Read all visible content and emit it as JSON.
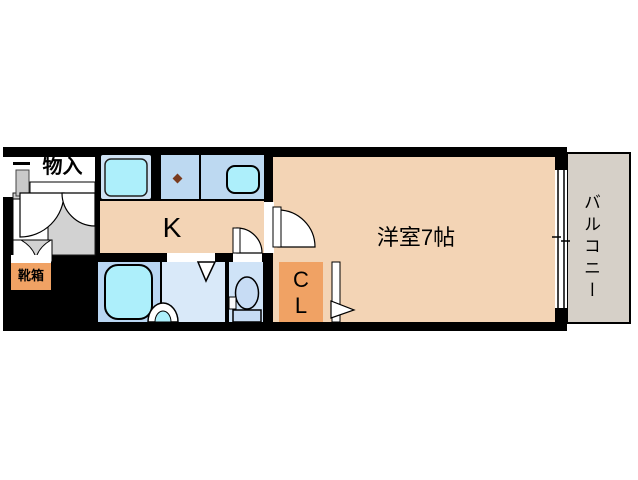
{
  "labels": {
    "storage": "物入",
    "shoe_box": "靴箱",
    "kitchen": "K",
    "western_room": "洋室7帖",
    "closet": "C\nL",
    "balcony": "バルコニー"
  },
  "colors": {
    "wall": "#000000",
    "room_floor": "#f3d4b5",
    "accent_orange": "#f0a264",
    "entry_gray": "#d2d2d2",
    "balcony_floor": "#d6d0c8",
    "fixture_cyan": "#adeffb",
    "pan_frame_blue": "#cfe2f4",
    "counter_blue": "#bdd9f1",
    "bath_blue": "#b9d6f2",
    "washroom_blue": "#d9e9f9",
    "toilet_blue": "#cfe3f7",
    "burner_dot": "#7a3b1e"
  }
}
